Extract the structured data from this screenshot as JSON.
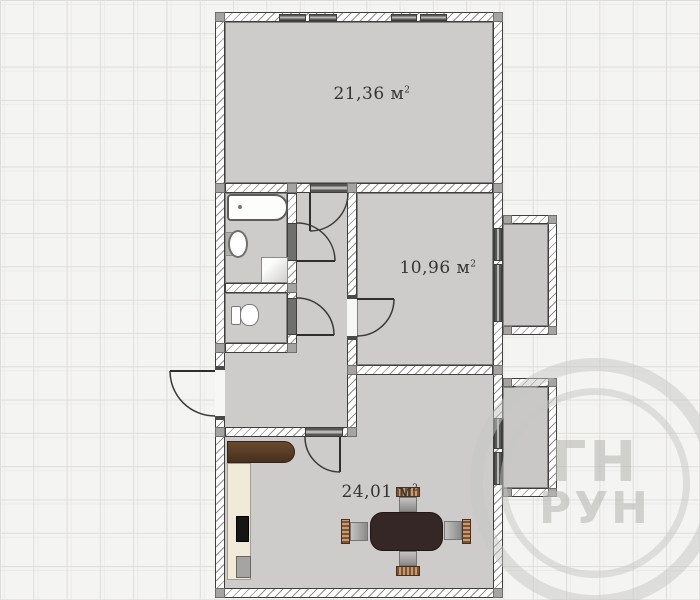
{
  "plan": {
    "rooms": [
      {
        "name": "room-large",
        "area": "21,36",
        "unit": " м",
        "sup": "2"
      },
      {
        "name": "room-middle",
        "area": "10,96",
        "unit": " м",
        "sup": "2"
      },
      {
        "name": "kitchen-living",
        "area": "24,01",
        "unit": " м",
        "sup": "2"
      }
    ],
    "watermark": {
      "line1": "ГН",
      "line2": "РУН"
    }
  }
}
